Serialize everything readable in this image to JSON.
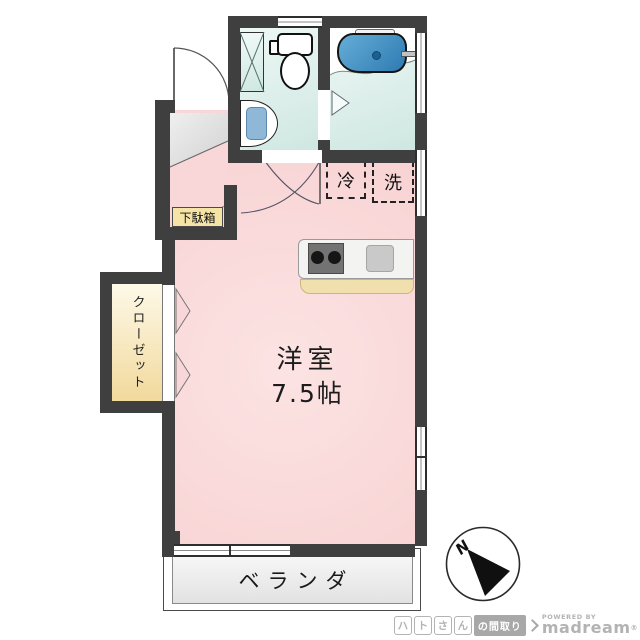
{
  "floorplan": {
    "main_room": {
      "name": "洋室",
      "size": "7.5帖"
    },
    "closet_label": "クローゼット",
    "shoe_cabinet_label": "下駄箱",
    "refrigerator_label": "冷",
    "washer_label": "洗",
    "veranda_label": "ベランダ",
    "compass_n": "N"
  },
  "watermark": {
    "char_boxes": [
      "ハ",
      "ト",
      "さ",
      "ん"
    ],
    "madori_label": "の間取り",
    "powered_by": "POWERED BY",
    "brand": "madream",
    "reg_mark": "®"
  },
  "colors": {
    "wall": "#3f3f3f",
    "room_pink": "#f9d6d7",
    "sanitary_cyan": "#d9ede8",
    "tub_blue": "#3f8fc4",
    "fixture_blue": "#8fb8d8",
    "closet_yellow": "#f3dc9f",
    "shoe_cabinet_yellow": "#f6e4a6",
    "kitchen_base_tan": "#f1dfae",
    "veranda_gray": "#ececec",
    "watermark_gray": "#b3b3b3"
  }
}
